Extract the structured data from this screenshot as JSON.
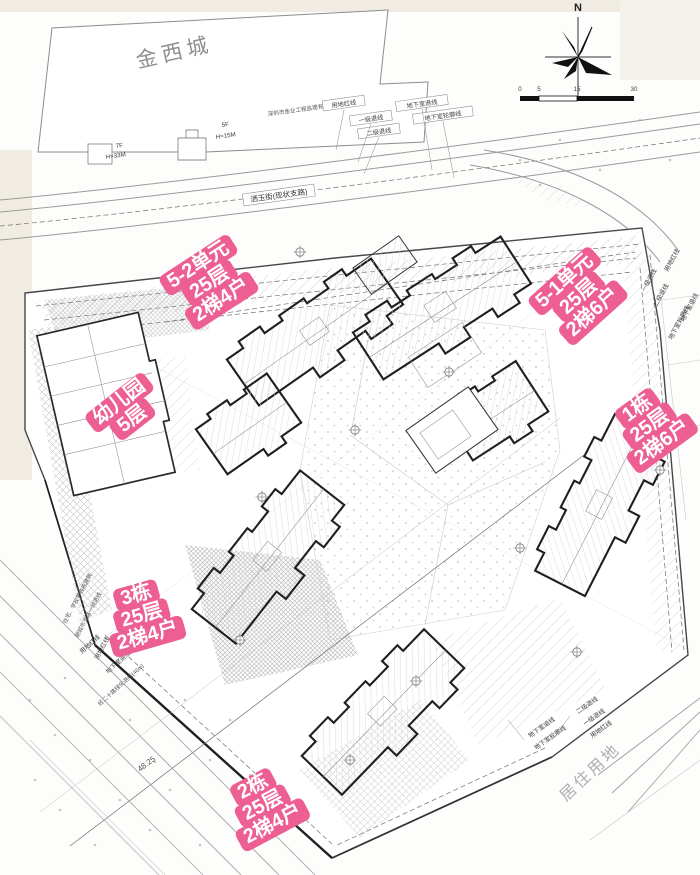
{
  "colors": {
    "pink": "#ed5f92",
    "paper": "#fdfdfc",
    "ink": "#1f1f1f",
    "gray_text": "#8f8f8f"
  },
  "compass": {
    "label": "N"
  },
  "scale_bar": {
    "ticks": [
      "0",
      "5",
      "15",
      "30"
    ]
  },
  "parcels": {
    "top_left": "金西城",
    "bottom_right": "居住用地"
  },
  "road": {
    "name": "洒玉街(现状支路)"
  },
  "pink_labels": {
    "unit_5_2": {
      "lines": [
        "5-2单元",
        "25层",
        "2梯4户"
      ]
    },
    "unit_5_1": {
      "lines": [
        "5-1单元",
        "25层",
        "2梯6户"
      ]
    },
    "kindergarten": {
      "lines": [
        "幼儿园",
        "5层"
      ]
    },
    "tower_1": {
      "lines": [
        "1栋",
        "25层",
        "2梯6户"
      ]
    },
    "tower_3": {
      "lines": [
        "3栋",
        "25层",
        "2梯4户"
      ]
    },
    "tower_2": {
      "lines": [
        "2栋",
        "25层",
        "2梯4户"
      ]
    }
  },
  "setback_labels": {
    "red_line": "用地红线",
    "first": "一级退线",
    "second": "二级退线",
    "basement": "地下室退线",
    "basement_outline": "地下室轮廓线"
  },
  "neighbor_notes": {
    "company": "深圳市金业工程监理有限公司",
    "f7": "7F",
    "h33": "H=33M",
    "f5": "5F",
    "h15": "H=15M"
  },
  "side_notes": {
    "note_a": "住宅、学校等独栋建筑",
    "note_b": "朝城市支路一侧退线",
    "road_setback": "经二十路绿化退线(46m)"
  },
  "dimensions": {
    "d1": "48.25"
  }
}
